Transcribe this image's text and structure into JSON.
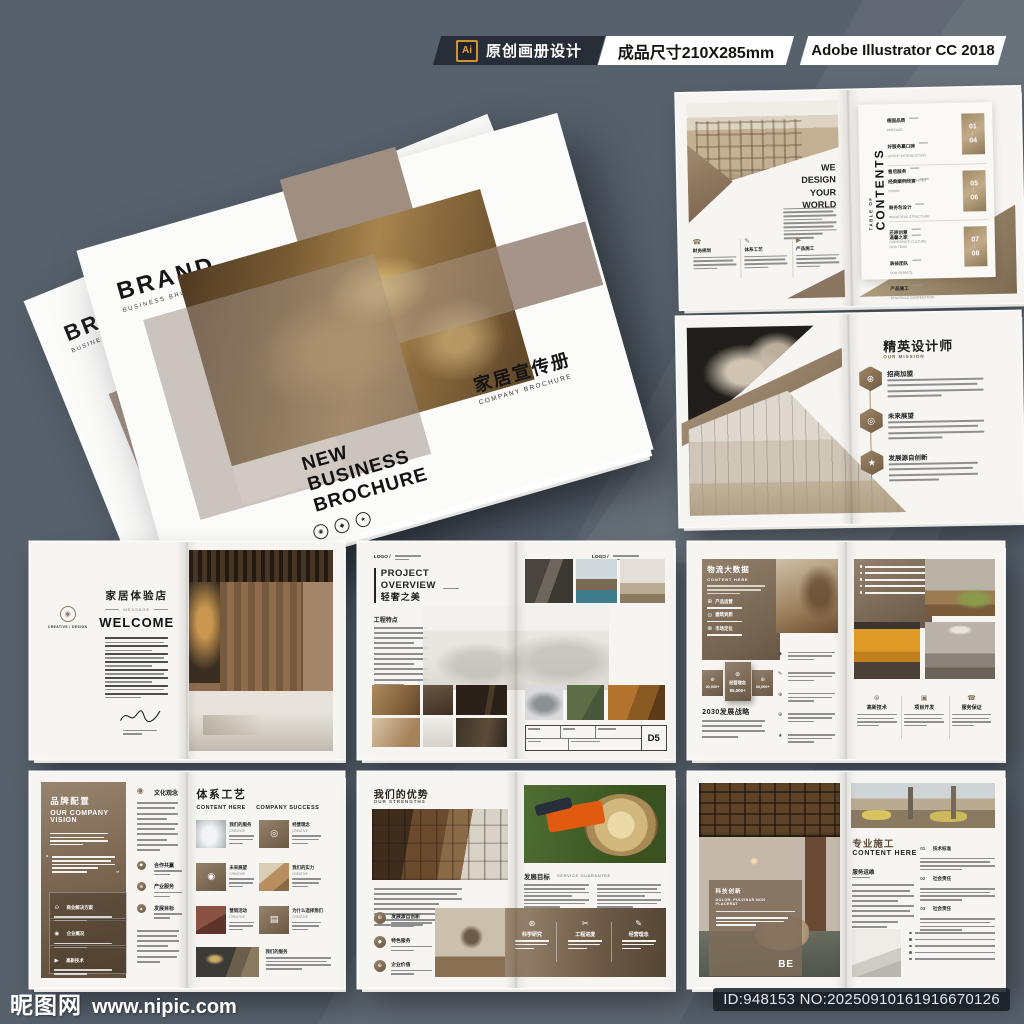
{
  "colors": {
    "bg": "#57616c",
    "accent": "#8d7a66",
    "taupe": "#a08e80",
    "panel_dark": "#685744",
    "banner_dark": "#272e37",
    "ai_orange": "#e8a33d"
  },
  "topbar": {
    "ai_badge": "Ai",
    "label": "原创画册设计",
    "size": "成品尺寸210X285mm",
    "software": "Adobe Illustrator CC 2018"
  },
  "footer": {
    "site": "昵图网",
    "url": "www.nipic.com",
    "id_text": "ID:948153 NO:20250910161916670126"
  },
  "cover": {
    "brand": "BRAND",
    "brand_sub": "BUSINESS BROCHURE",
    "back_brand": "BRAND",
    "back_sub": "BUSINESS BROCHURE",
    "t1": "NEW",
    "t2": "BUSINESS",
    "t3": "BROCHURE",
    "cn_title": "家居宣传册",
    "cn_sub": "COMPANY BROCHURE"
  },
  "contents": {
    "headline": [
      "WE",
      "DESIGN",
      "YOUR",
      "WORLD"
    ],
    "toc_top": "TABLE OF",
    "toc_main": "CONTENTS",
    "dots": "⋮",
    "features": [
      "财务规划",
      "体系工艺",
      "产品施工"
    ],
    "groups": [
      {
        "rows": [
          [
            "德国品质",
            "PREFACE"
          ],
          [
            "好服务赢口碑",
            "GROUP INTRODUCTION"
          ],
          [
            "售后服务",
            "LEADERSHIP REMARKS"
          ]
        ],
        "from": "01",
        "to": "04"
      },
      {
        "rows": [
          [
            "经典案例欣赏",
            "VISION"
          ],
          [
            "商务包设计",
            "INDUSTRIAL STRUCTURE"
          ],
          [
            "还原创意",
            "CORPORATE CULTURE"
          ]
        ],
        "from": "05",
        "to": "06"
      },
      {
        "rows": [
          [
            "温馨之家",
            "OUR TEAM"
          ],
          [
            "装修团队",
            "OUR SERVICE"
          ],
          [
            "产品施工",
            "STRATEGIC COOPERATION"
          ]
        ],
        "from": "07",
        "to": "08"
      }
    ]
  },
  "mission": {
    "title": "精英设计师",
    "sub": "OUR MISSION",
    "items": [
      "招商加盟",
      "未来展望",
      "发展源自创新"
    ]
  },
  "welcome": {
    "badge": "CREATIVE / DESIGN",
    "title": "家居体验店",
    "tag": "MESSAGE",
    "heading": "WELCOME"
  },
  "project": {
    "logo": "LOGO /",
    "t1": "PROJECT",
    "t2": "OVERVIEW",
    "cn": "轻奢之美",
    "sub": "工程特点",
    "marker": "D5"
  },
  "bigdata": {
    "title": "物流大数据",
    "sub": "CONTENT HERE",
    "items": [
      "产品运营",
      "建筑资质",
      "市场定位"
    ],
    "stats": [
      {
        "v": "30,000+"
      },
      {
        "label": "经营理念",
        "v": "85,000+"
      },
      {
        "v": "30,000+"
      }
    ],
    "strategy": "2030发展战略",
    "features": [
      "高新技术",
      "项目开发",
      "服务保证"
    ]
  },
  "vision": {
    "title": "品牌配置",
    "sub1": "OUR COMPANY",
    "sub2": "VISION",
    "cards": [
      "商业解决方案",
      "企业概况",
      "高新技术"
    ],
    "col_top": "文化观念",
    "col_items": [
      "合作共赢",
      "产业服务",
      "发展目标"
    ],
    "r_title": "体系工艺",
    "r_left": "CONTENT HERE",
    "r_right": "COMPANY SUCCESS",
    "grid": [
      [
        "我们的服务",
        "CREATIVE"
      ],
      [
        "经营理念",
        "CREATIVE"
      ],
      [
        "未来展望",
        "CREATIVE"
      ],
      [
        "我们的实力",
        "CREATIVE"
      ],
      [
        "营销活动",
        "CREATIVE"
      ],
      [
        "为什么选择我们",
        "CREATIVE"
      ]
    ],
    "bottom_label": "我们的服务"
  },
  "strengths": {
    "title": "我们的优势",
    "sub": "OUR STRENGTHS",
    "items": [
      "发展源自创新",
      "特色服务",
      "企业价值"
    ],
    "r_title": "发展目标",
    "r_sub": "SERVICE GUARANTEE",
    "band": [
      "科学研究",
      "工程进度",
      "经营理念"
    ]
  },
  "construction": {
    "card_title": "科技创新",
    "card_sub1": "DOLOR, PULVINAR NON",
    "card_sub2": "PLACERAT",
    "mark": "BE",
    "title": "专业施工",
    "sub": "CONTENT HERE",
    "section": "服务运维",
    "list": [
      [
        "01",
        "技术标准"
      ],
      [
        "02",
        "社会责任"
      ],
      [
        "03",
        "社会责任"
      ]
    ]
  },
  "icons": {
    "features": [
      "☎",
      "✎",
      "▶"
    ],
    "hex": [
      "⊛",
      "◎",
      "★"
    ],
    "badge": "◉",
    "data_items": [
      "⊕",
      "⊙",
      "⊗"
    ],
    "stats": [
      "⊚",
      "⊛",
      "⊕"
    ],
    "data_features": [
      "⊛",
      "▣",
      "☎"
    ],
    "vision_cards": [
      "⊙",
      "◉",
      "▶"
    ],
    "vision_col_top": "◉",
    "vision_col": [
      "◆",
      "⊕",
      "▲"
    ],
    "vision_grid": [
      "◎",
      "◉",
      "▤"
    ],
    "strength": [
      "⊛",
      "◆",
      "⊕"
    ],
    "band": [
      "⊛",
      "✂",
      "✎"
    ],
    "cover": [
      "◉",
      "◆",
      "★"
    ]
  }
}
